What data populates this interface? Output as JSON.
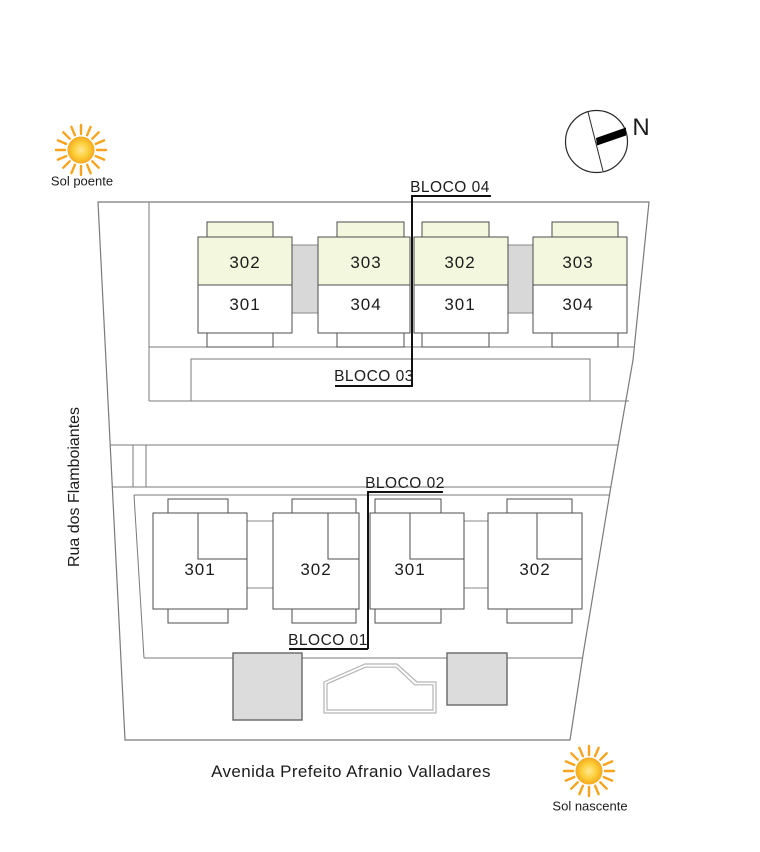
{
  "blocks": {
    "bloco_04": "BLOCO 04",
    "bloco_03": "BLOCO 03",
    "bloco_02": "BLOCO 02",
    "bloco_01": "BLOCO 01"
  },
  "top_row_buildings": [
    {
      "upper_unit": "302",
      "lower_unit": "301"
    },
    {
      "upper_unit": "303",
      "lower_unit": "304"
    },
    {
      "upper_unit": "302",
      "lower_unit": "301"
    },
    {
      "upper_unit": "303",
      "lower_unit": "304"
    }
  ],
  "bottom_row_buildings": [
    {
      "unit": "301"
    },
    {
      "unit": "302"
    },
    {
      "unit": "301"
    },
    {
      "unit": "302"
    }
  ],
  "streets": {
    "left_street": "Rua dos Flamboiantes",
    "bottom_street": "Avenida Prefeito Afranio Valladares"
  },
  "legend": {
    "sun_west_label": "Sol poente",
    "sun_east_label": "Sol nascente",
    "compass_north": "N"
  },
  "colors": {
    "upper_unit_fill": "#f2f7dd",
    "lower_unit_fill": "#ffffff",
    "connector_fill": "#d8d8d8",
    "amenity_fill": "#dcdcdc",
    "site_line": "#7a7a7a",
    "building_line": "#4d4d4d",
    "annotation_line": "#111111",
    "sun_core": "#fbc92e",
    "sun_rays": "#f6a41d"
  }
}
